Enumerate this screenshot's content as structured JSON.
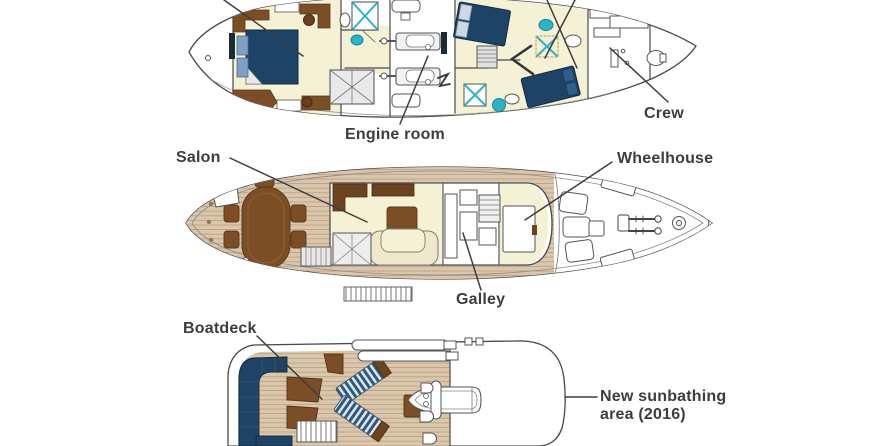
{
  "labels": {
    "engine_room": "Engine room",
    "crew": "Crew",
    "salon": "Salon",
    "wheelhouse": "Wheelhouse",
    "galley": "Galley",
    "boatdeck": "Boatdeck",
    "sunbathing_line1": "New sunbathing",
    "sunbathing_line2": "area (2016)"
  },
  "colors": {
    "background": "#ffffff",
    "outline": "#4a4a4a",
    "label_text": "#3d3d3d",
    "cabin_floor_cream": "#f4f1d5",
    "wood_deck": "#dac7ab",
    "wood_plank_line": "#b79f80",
    "navy_upholstery": "#1d4467",
    "pillow_blue": "#7fa0c3",
    "furniture_brown": "#7c4e25",
    "sofa_dark_brown": "#6b4320",
    "teal_fixture": "#2ab4c8"
  }
}
